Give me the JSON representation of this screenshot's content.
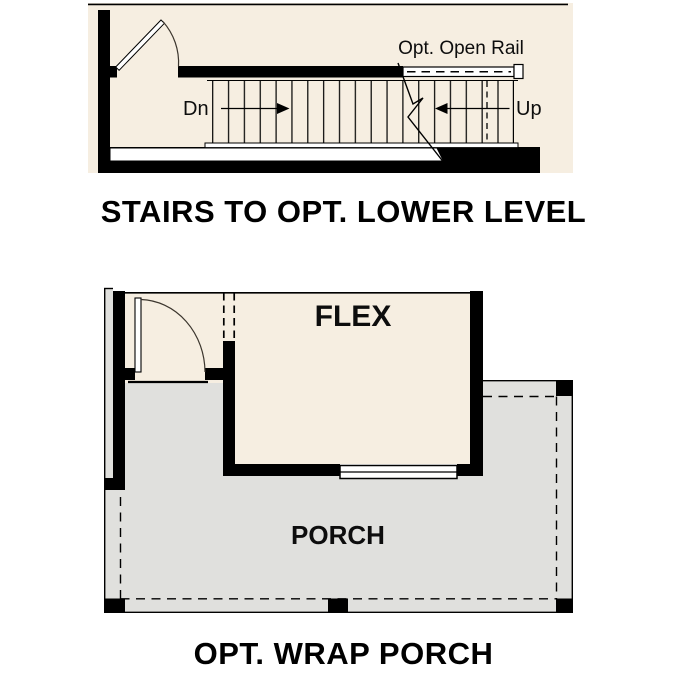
{
  "stairs_diagram": {
    "title": "STAIRS TO OPT. LOWER LEVEL",
    "down_label": "Dn",
    "up_label": "Up",
    "open_rail_label": "Opt. Open Rail"
  },
  "porch_diagram": {
    "title": "OPT. WRAP PORCH",
    "flex_label": "FLEX",
    "porch_label": "PORCH"
  },
  "colors": {
    "interior_floor": "#f6eee1",
    "porch_floor": "#e0e0dd",
    "wall": "#000000",
    "text": "#000000",
    "page_background": "#ffffff"
  }
}
